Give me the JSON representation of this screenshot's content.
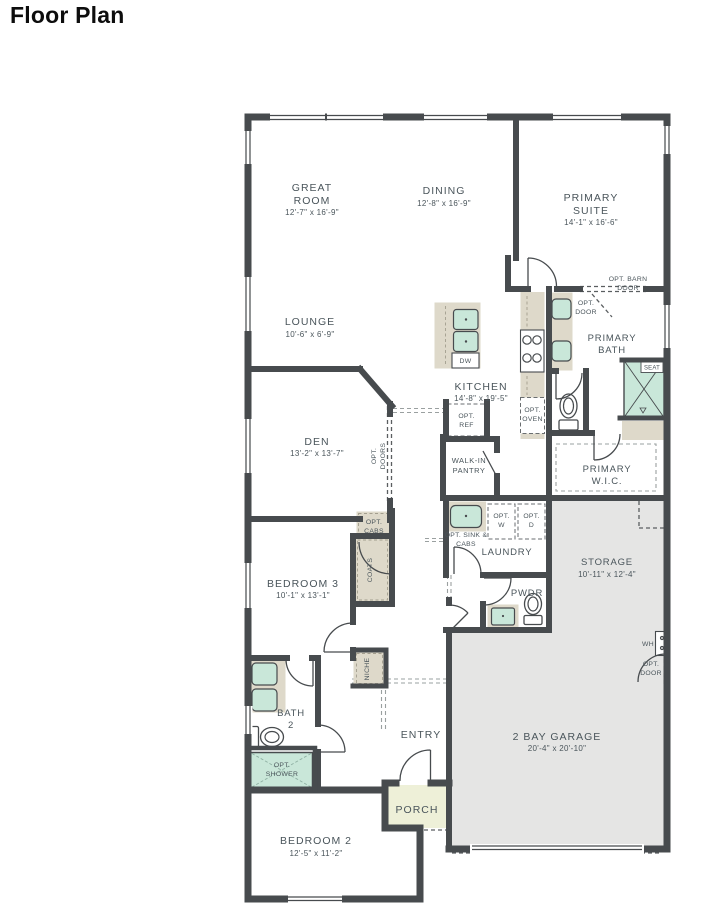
{
  "title": "Floor Plan",
  "colors": {
    "wall": "#474b4e",
    "label": "#4a555b",
    "casework_beige": "#ded9ca",
    "fixture_teal": "#c9e7d9",
    "garage_gray": "#e5e5e4",
    "porch_green": "#eef0d8"
  },
  "rooms": {
    "great_room": {
      "lines": [
        "GREAT",
        "ROOM"
      ],
      "dims": "12'-7\" x 16'-9\""
    },
    "dining": {
      "lines": [
        "DINING"
      ],
      "dims": "12'-8\" x 16'-9\""
    },
    "primary_suite": {
      "lines": [
        "PRIMARY",
        "SUITE"
      ],
      "dims": "14'-1\" x 16'-6\""
    },
    "lounge": {
      "lines": [
        "LOUNGE"
      ],
      "dims": "10'-6\" x 6'-9\""
    },
    "kitchen": {
      "lines": [
        "KITCHEN"
      ],
      "dims": "14'-8\" x 19'-5\""
    },
    "den": {
      "lines": [
        "DEN"
      ],
      "dims": "13'-2\" x 13'-7\""
    },
    "primary_bath": {
      "lines": [
        "PRIMARY",
        "BATH"
      ]
    },
    "primary_wic": {
      "lines": [
        "PRIMARY",
        "W.I.C."
      ]
    },
    "walk_in_pantry": {
      "lines": [
        "WALK-IN",
        "PANTRY"
      ]
    },
    "laundry": {
      "lines": [
        "LAUNDRY"
      ]
    },
    "pwdr": {
      "lines": [
        "PWDR"
      ]
    },
    "storage": {
      "lines": [
        "STORAGE"
      ],
      "dims": "10'-11\" x 12'-4\""
    },
    "bedroom3": {
      "lines": [
        "BEDROOM 3"
      ],
      "dims": "10'-1\" x 13'-1\""
    },
    "bath2": {
      "lines": [
        "BATH",
        "2"
      ]
    },
    "entry": {
      "lines": [
        "ENTRY"
      ]
    },
    "porch": {
      "lines": [
        "PORCH"
      ]
    },
    "garage": {
      "lines": [
        "2 BAY GARAGE"
      ],
      "dims": "20'-4\" x 20'-10\""
    },
    "bedroom2": {
      "lines": [
        "BEDROOM 2"
      ],
      "dims": "12'-5\" x 11'-2\""
    }
  },
  "annotations": {
    "opt_barn_door": {
      "lines": [
        "OPT. BARN",
        "DOOR"
      ]
    },
    "opt_door_bath": {
      "lines": [
        "OPT.",
        "DOOR"
      ]
    },
    "opt_door_garage": {
      "lines": [
        "OPT.",
        "DOOR"
      ]
    },
    "opt_ref": {
      "lines": [
        "OPT.",
        "REF"
      ]
    },
    "opt_oven": {
      "lines": [
        "OPT.",
        "OVEN"
      ]
    },
    "dw": "DW",
    "seat": "SEAT",
    "opt_sink_cabs": {
      "lines": [
        "OPT. SINK &",
        "CABS"
      ]
    },
    "opt_w": {
      "lines": [
        "OPT.",
        "W"
      ]
    },
    "opt_d": {
      "lines": [
        "OPT.",
        "D"
      ]
    },
    "opt_cabs": {
      "lines": [
        "OPT.",
        "CABS"
      ]
    },
    "coats": "COATS",
    "niche": "NICHE",
    "opt_doors": {
      "lines": [
        "OPT.",
        "DOORS"
      ]
    },
    "opt_shower": {
      "lines": [
        "OPT.",
        "SHOWER"
      ]
    },
    "wh": "WH"
  }
}
